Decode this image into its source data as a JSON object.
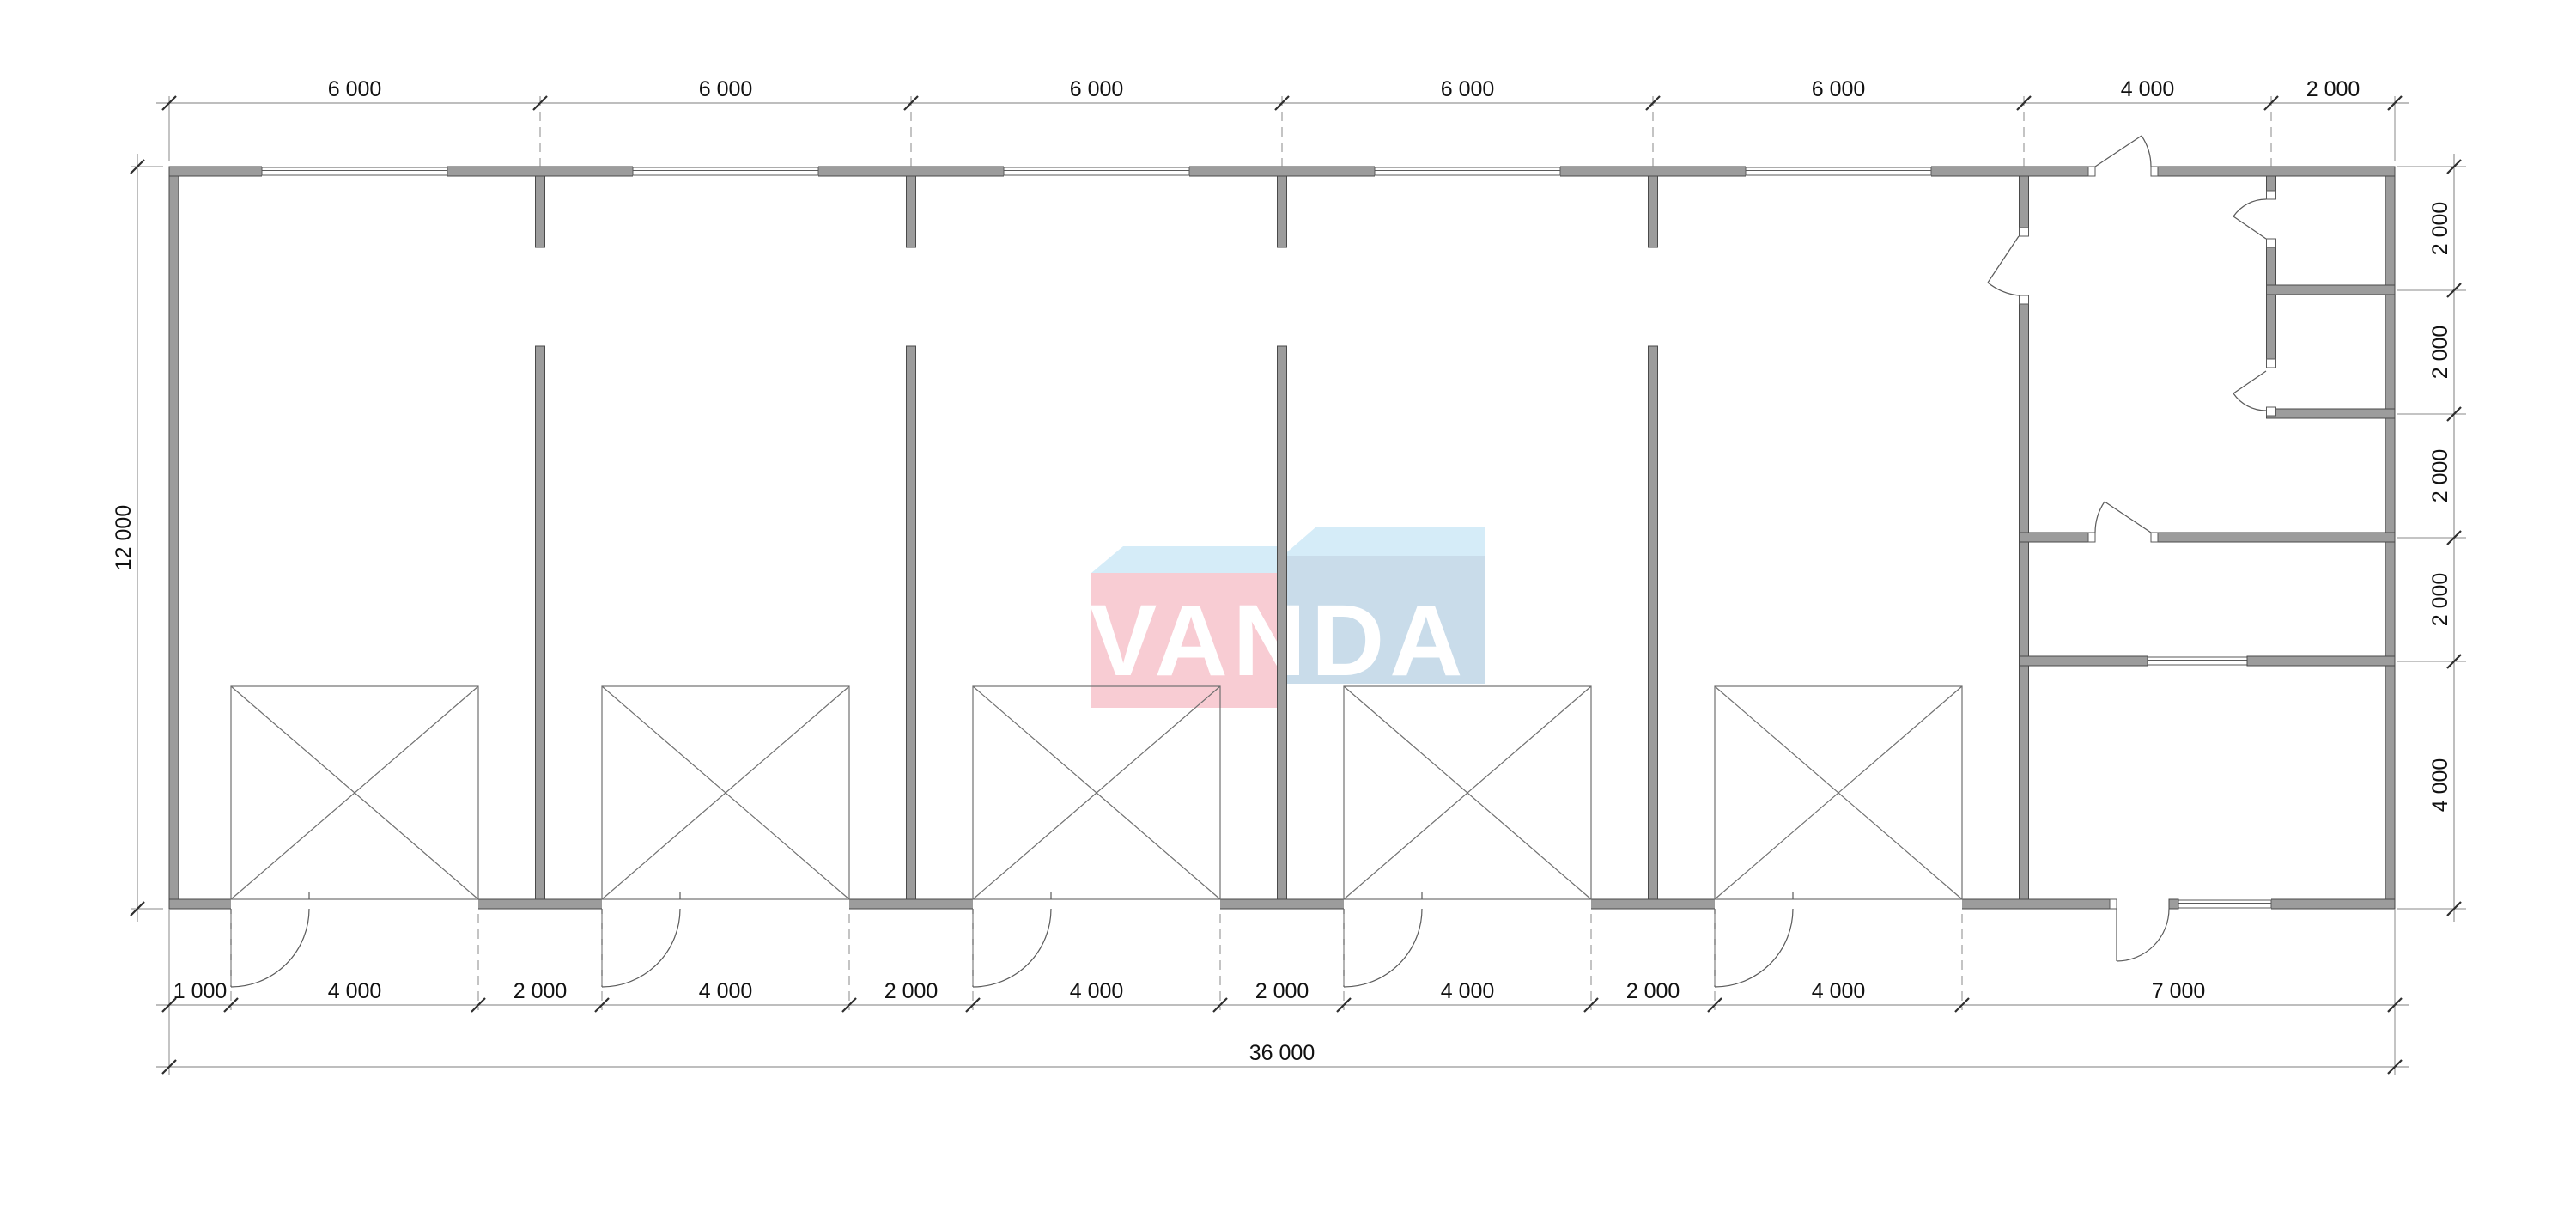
{
  "logo": {
    "text": "VANDA"
  },
  "colors": {
    "logo_pink": "#f8ccd3",
    "logo_blue": "#c9dcea",
    "logo_top": "#d5ecf8",
    "wall_gray": "#9c9c9c"
  },
  "dims": {
    "top": [
      {
        "label": "6 000"
      },
      {
        "label": "6 000"
      },
      {
        "label": "6 000"
      },
      {
        "label": "6 000"
      },
      {
        "label": "6 000"
      },
      {
        "label": "4 000"
      },
      {
        "label": "2 000"
      }
    ],
    "bottom_rooms": [
      {
        "label": "1 000"
      },
      {
        "label": "4 000"
      },
      {
        "label": "2 000"
      },
      {
        "label": "4 000"
      },
      {
        "label": "2 000"
      },
      {
        "label": "4 000"
      },
      {
        "label": "2 000"
      },
      {
        "label": "4 000"
      },
      {
        "label": "2 000"
      },
      {
        "label": "4 000"
      },
      {
        "label": "7 000"
      }
    ],
    "bottom_total": {
      "label": "36 000"
    },
    "left": {
      "label": "12 000"
    },
    "right": [
      {
        "label": "2 000"
      },
      {
        "label": "2 000"
      },
      {
        "label": "2 000"
      },
      {
        "label": "2 000"
      },
      {
        "label": "4 000"
      }
    ]
  }
}
